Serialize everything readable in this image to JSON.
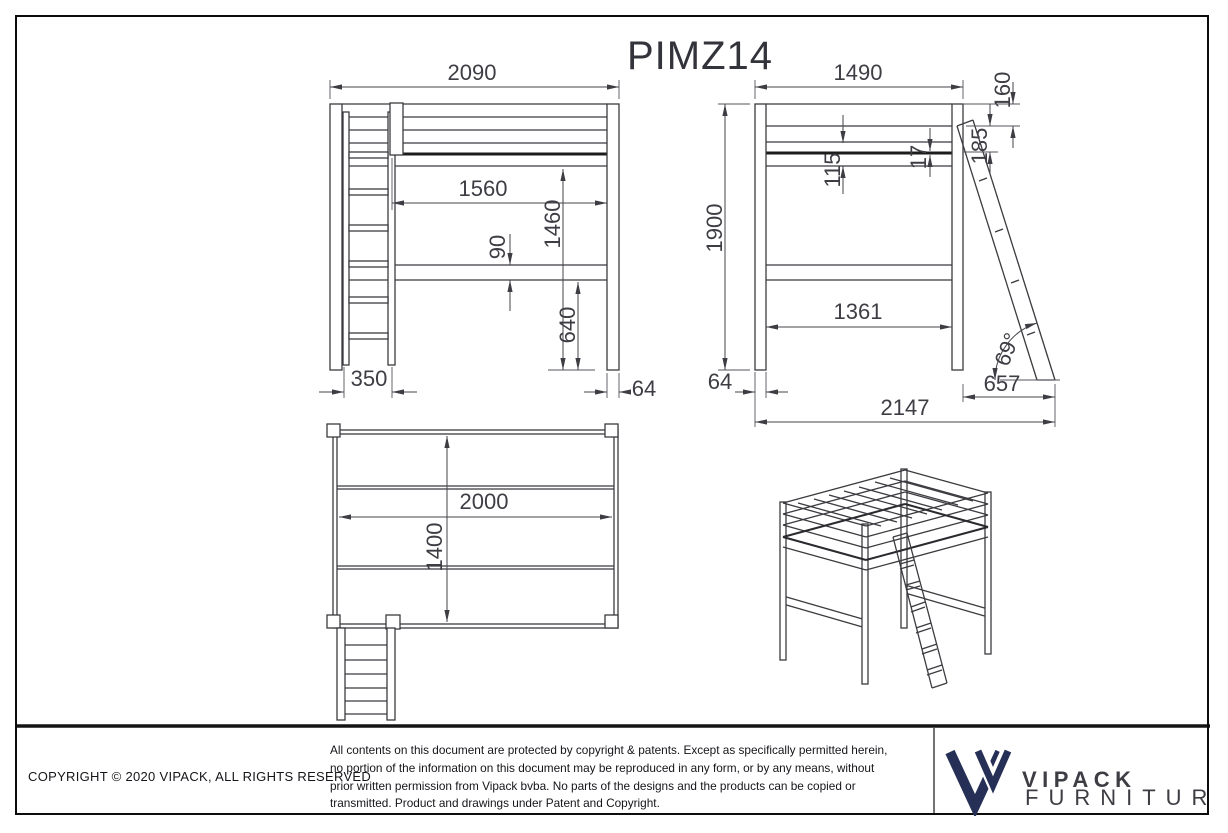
{
  "sheet": {
    "title": "PIMZ14"
  },
  "dimensions": {
    "front": {
      "overall_width": "2090",
      "inner_length": "1560",
      "underbed_height": "1460",
      "rail_height": "90",
      "lower_rail_clearance": "640",
      "ladder_width": "350",
      "post_thickness": "64"
    },
    "side": {
      "overall_depth": "1490",
      "top_rail_height": "160",
      "guardrail_height": "185",
      "base_offset": "115",
      "slat_thickness": "17",
      "overall_height": "1900",
      "inner_depth": "1361",
      "post_thickness": "64",
      "ladder_reach": "657",
      "total_footprint": "2147",
      "ladder_angle": "69°"
    },
    "top": {
      "bed_length": "2000",
      "bed_width": "1400"
    }
  },
  "footer": {
    "copyright": "COPYRIGHT  © 2020 VIPACK, ALL RIGHTS RESERVED",
    "disclaimer_lines": [
      "All contents on this document are protected by copyright & patents. Except as specifically permitted herein,",
      "no portion of the information on this document may be reproduced in any form, or by any means, without",
      "prior written permission from Vipack bvba. No parts of the designs and the products can be copied or",
      "transmitted. Product and drawings under Patent and Copyright."
    ],
    "logo": {
      "brand": "VIPACK",
      "tagline": "FURNITURE"
    }
  },
  "colors": {
    "line": "#3b3b40",
    "dim_text": "#3d3d44",
    "logo_navy": "#262f55",
    "background": "#ffffff"
  }
}
